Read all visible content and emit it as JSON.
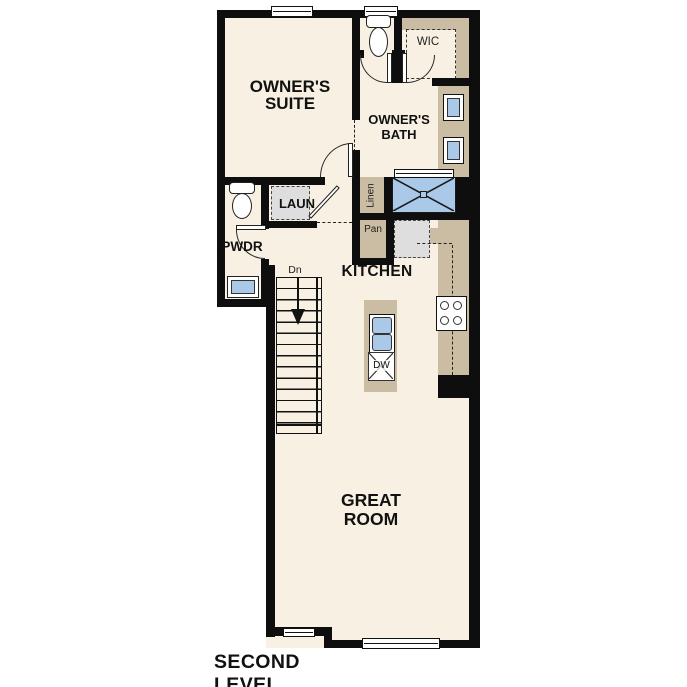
{
  "caption": "SECOND LEVEL",
  "rooms": {
    "owners_suite": "OWNER'S\nSUITE",
    "owners_bath": "OWNER'S\nBATH",
    "wic": "WIC",
    "laundry": "LAUN",
    "powder": "PWDR",
    "linen": "Linen",
    "pantry": "Pan",
    "kitchen": "KITCHEN",
    "great_room": "GREAT\nROOM"
  },
  "stairs": {
    "down_label": "Dn"
  },
  "appliances": {
    "dishwasher_label": "DW"
  },
  "colors": {
    "background": "#ffffff",
    "floor": "#f8f1e3",
    "wall": "#0e0e0e",
    "cabinetry_tan": "#cabda3",
    "plumbing_blue": "#aac8e8",
    "appliance_gray": "#dedede",
    "text": "#111111"
  }
}
